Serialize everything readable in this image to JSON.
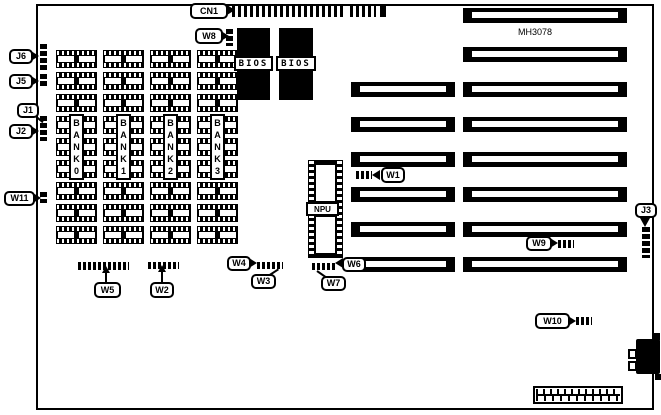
{
  "diagram": {
    "board_model": "MH3078",
    "bios_label": "BIOS",
    "npu_label": "NPU",
    "memory_banks": [
      {
        "label": "BANK0"
      },
      {
        "label": "BANK1"
      },
      {
        "label": "BANK2"
      },
      {
        "label": "BANK3"
      }
    ],
    "callouts": {
      "cn1": "CN1",
      "w8": "W8",
      "j6": "J6",
      "j5": "J5",
      "j1": "J1",
      "j2": "J2",
      "w11": "W11",
      "w1": "W1",
      "w2": "W2",
      "w3": "W3",
      "w4": "W4",
      "w5": "W5",
      "w6": "W6",
      "w7": "W7",
      "w9": "W9",
      "w10": "W10",
      "j3": "J3"
    },
    "colors": {
      "ink": "#000000",
      "paper": "#ffffff"
    }
  }
}
